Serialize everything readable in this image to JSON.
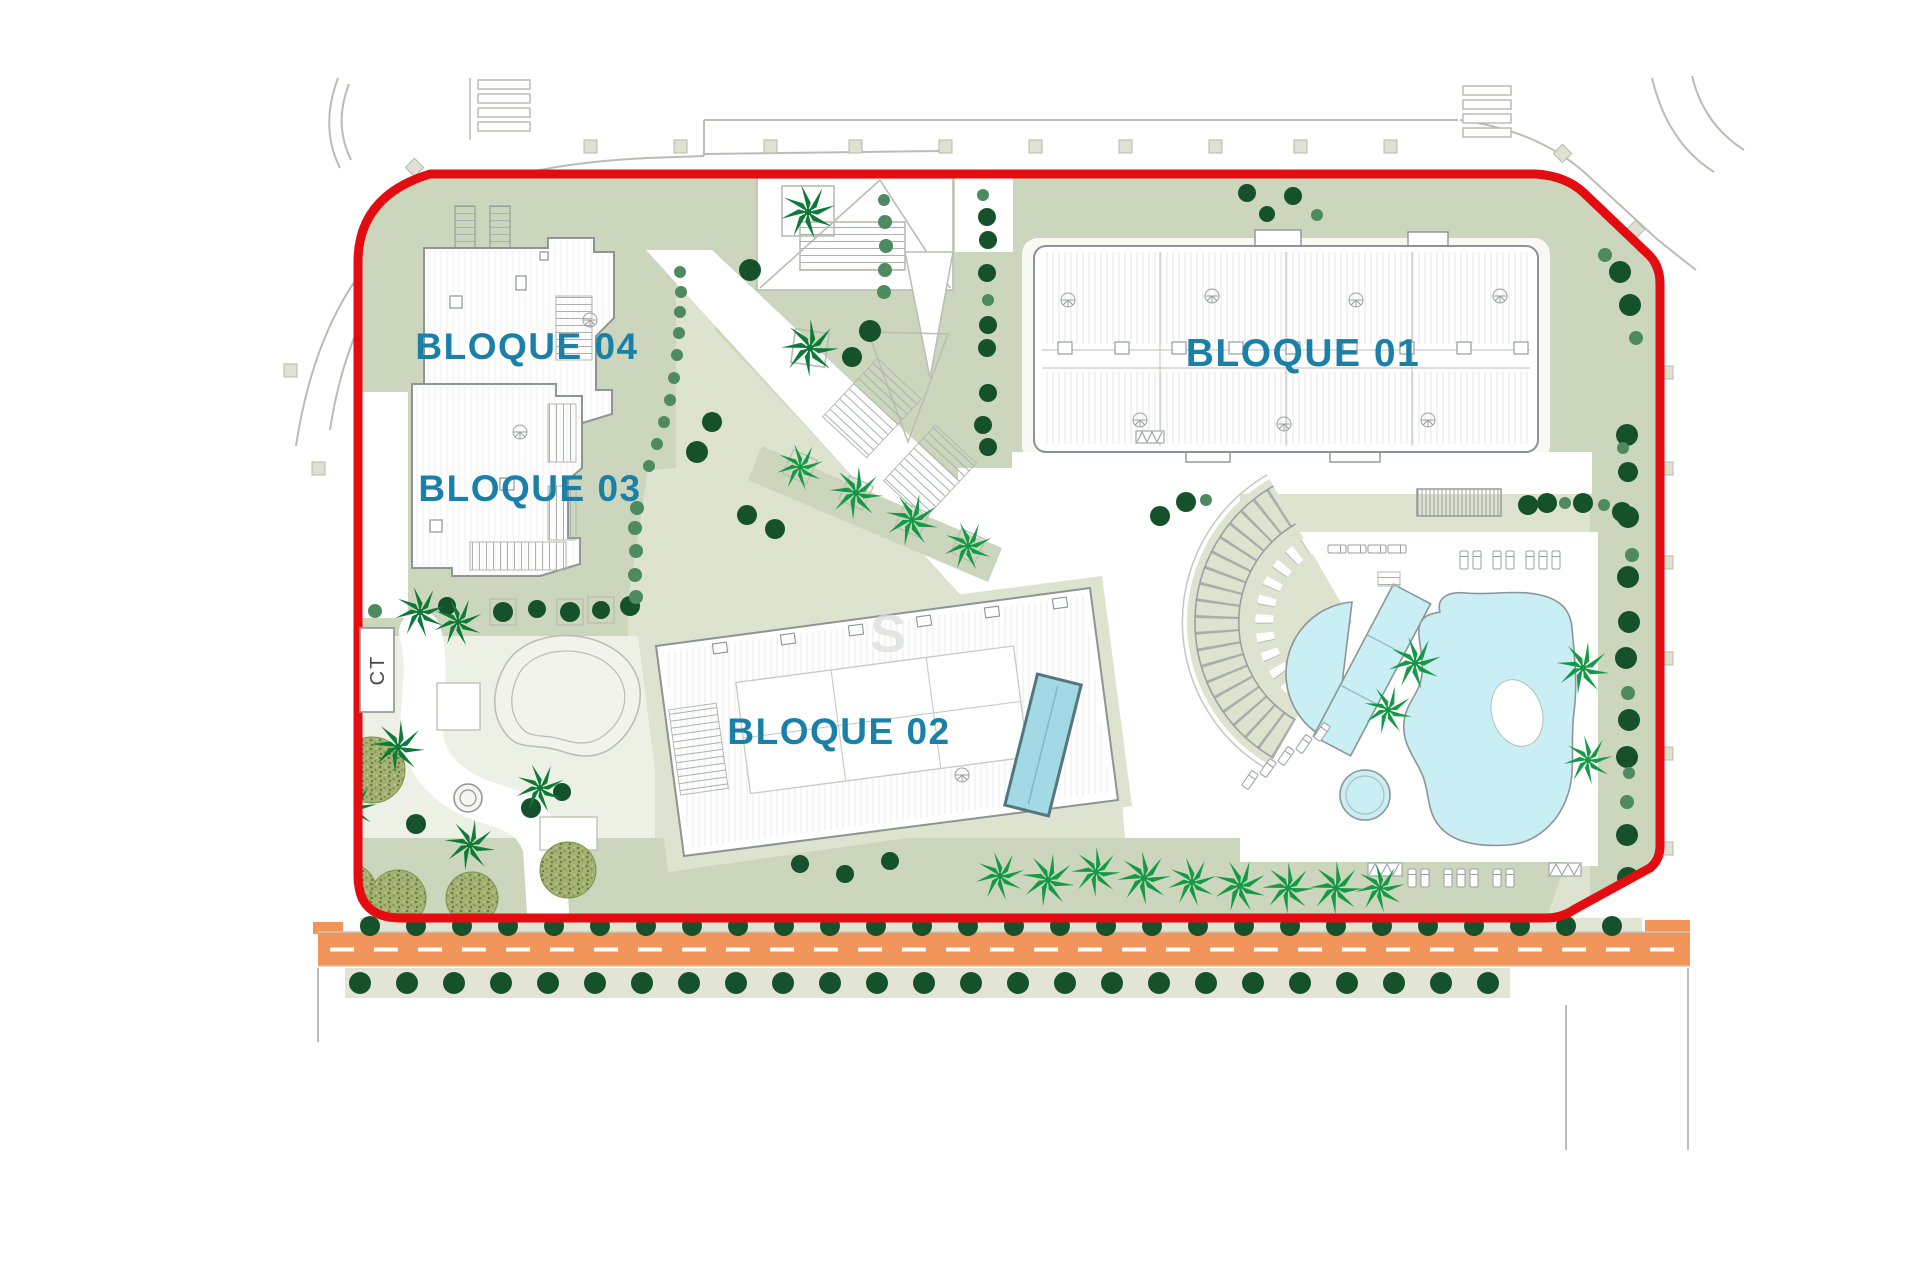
{
  "plan": {
    "labels": {
      "bloque01": "BLOQUE 01",
      "bloque02": "BLOQUE 02",
      "bloque03": "BLOQUE 03",
      "bloque04": "BLOQUE 04"
    },
    "transformer_label": "CT",
    "watermark": "S"
  },
  "colors": {
    "boundary_red": "#e30d11",
    "road_orange": "#f2955a",
    "road_dash": "#ffffff",
    "pool_blue": "#c9eef4",
    "pool_outline": "#8c9698",
    "rooftop_pool_blue": "#a3d9e4",
    "rooftop_pool_border": "#54777e",
    "label_teal": "#1a80a8",
    "tree_dark": "#15522b",
    "tree_mid": "#4e8a5f",
    "palm_bright": "#149a47",
    "palm_dark": "#0d7a38",
    "olive_fill": "#a3b172",
    "olive_dot": "#69803f",
    "sage": "#ccd6bc",
    "sage_light": "#dde3cf",
    "sage_pale": "#edf0e4",
    "paving": "#e2e4d4",
    "beige_sq": "#e0e1d3",
    "outline": "#8e9494",
    "line_light": "#b9bdb4",
    "ct_text": "#4a4a4a",
    "watermark_gray": "#dcdedb"
  }
}
